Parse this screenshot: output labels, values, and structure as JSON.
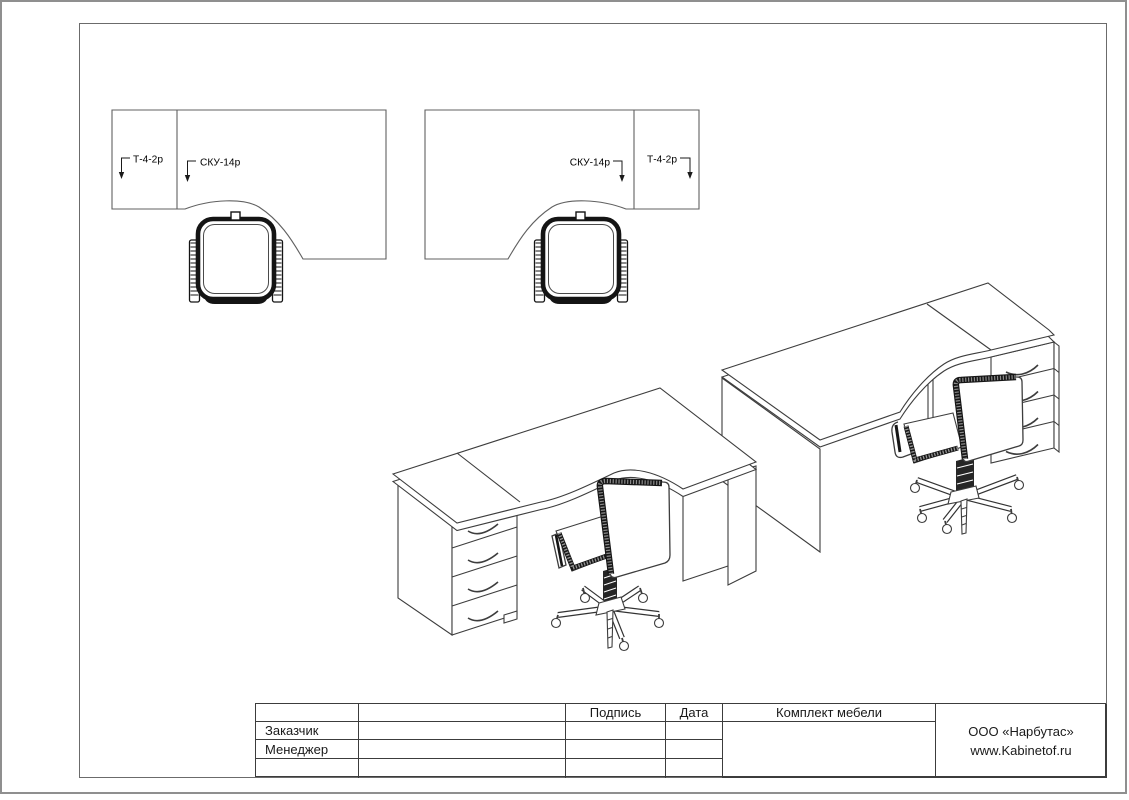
{
  "plan_labels": {
    "left_pedestal": "Т-4-2р",
    "left_desk": "СКУ-14р",
    "right_desk": "СКУ-14р",
    "right_pedestal": "Т-4-2р"
  },
  "title_block": {
    "col_signature": "Подпись",
    "col_date": "Дата",
    "col_set": "Комплект мебели",
    "row_customer": "Заказчик",
    "row_manager": "Менеджер",
    "company_name": "ООО «Нарбутас»",
    "company_site": "www.Kabinetof.ru"
  },
  "colors": {
    "line": "#3d3d3d",
    "plan_line": "#606060",
    "chair_dark": "#161616"
  }
}
